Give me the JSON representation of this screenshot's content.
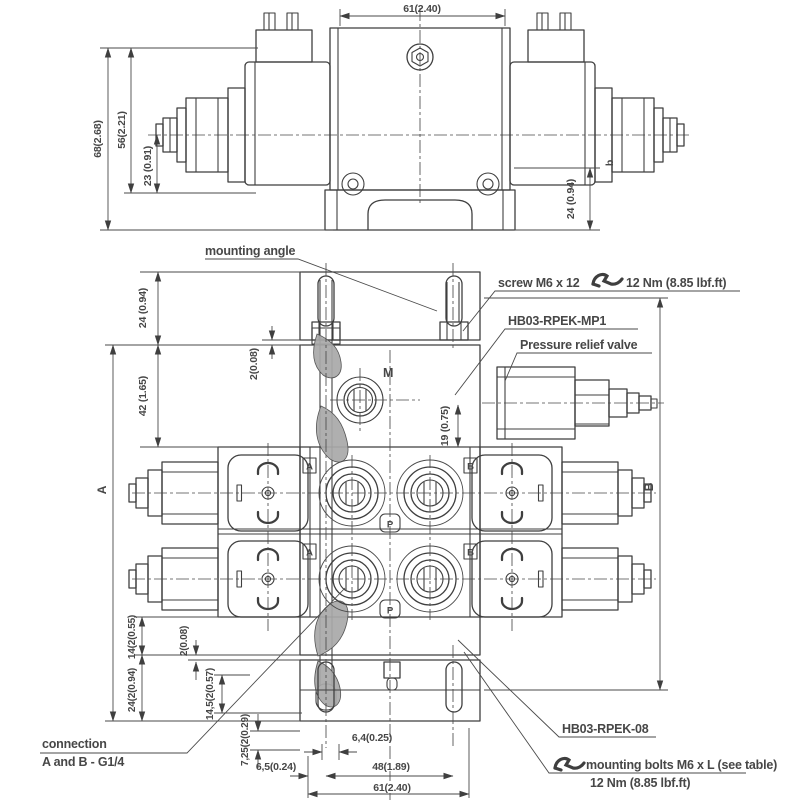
{
  "colors": {
    "line": "#3f3f3f",
    "text": "#474747",
    "shade": "#a8a8a8"
  },
  "top_view": {
    "dims": {
      "width": "61(2.40)",
      "total_height": "68(2.68)",
      "body_height": "56(2.21)",
      "center_height": "23 (0.91)",
      "angle_height": "24 (0.94)",
      "marker": "b"
    }
  },
  "bottom_view": {
    "dims": {
      "top_offset": "24 (0.94)",
      "block_top": "42 (1.65)",
      "gap_top": "2(0.08)",
      "relief_offset": "19 (0.75)",
      "side_left": "A",
      "side_right": "B",
      "port_m": "M",
      "bottom_14": "14(2(0.55)",
      "bottom_24": "24(2(0.94)",
      "bottom_145": "14,5(2(0.57)",
      "gap_bottom": "2(0.08)",
      "bottom_725": "7,25(2(0.29)",
      "slot": "6,4(0.25)",
      "edge": "6,5(0.24)",
      "bolt_spacing": "48(1.89)",
      "width": "61(2.40)"
    },
    "ports": {
      "a1": "A",
      "a2": "A",
      "b1": "B",
      "b2": "B",
      "p1": "P",
      "p2": "P"
    }
  },
  "annotations": {
    "mounting_angle": "mounting angle",
    "screw": "screw M6 x 12",
    "screw_torque": "12 Nm (8.85 lbf.ft)",
    "model_mp1": "HB03-RPEK-MP1",
    "relief_valve": "Pressure relief valve",
    "model_08": "HB03-RPEK-08",
    "bolts": "mounting bolts M6 x L (see table)",
    "bolts_torque": "12 Nm (8.85 lbf.ft)",
    "connection_1": "connection",
    "connection_2": "A and B - G1/4"
  }
}
